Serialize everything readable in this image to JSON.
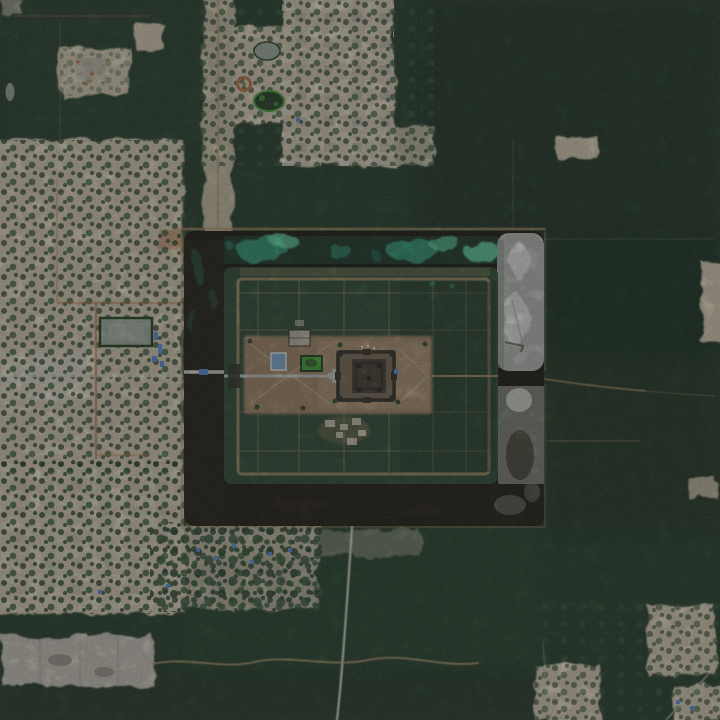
{
  "scene": {
    "type": "satellite-photograph",
    "subject": "Angkor Wat temple complex, aerial satellite view",
    "description": "Satellite image of the Angkor Wat temple complex: a dark rectangular moat with green algae blooms along its north arm and pale silted water on its east arm surrounds a forested enclosure containing the central stone temple on a cleared tan esplanade; village settlements and cleared land lie to the west and south-west, dense forest to the east and south, with dirt roads, ponds and a long grey cleared strip in the lower-left."
  },
  "features": {
    "moat": "Rectangular moat surrounding the temple enclosure",
    "north_moat_algae": "Bright green algae blooms in the north arm of the moat",
    "east_moat_silt": "Pale silted grey-white water in the east arm of the moat",
    "temple": "Central temple with concentric square galleries and quincunx towers",
    "esplanade": "Cleared tan esplanade around the central temple",
    "causeway": "West causeway and bridge crossing the moat",
    "enclosure": "Forested temple enclosure with a grid of paths inside a walled rectangle",
    "west_village": "Village and cleared land west of the moat",
    "top_village": "Patchwork village clearings north of the moat",
    "east_forest": "Dense forest east of the moat",
    "south_road": "Light dirt road running south from the moat",
    "cleared_strip": "Large grey cleared strip in the south-west",
    "ponds": "Village ponds, a blue pool and a green algae pond"
  },
  "colors": {
    "forest_base": "#203825",
    "forest_dark": "#172b1c",
    "forest_mid": "#26422c",
    "forest_light": "#2e4f35",
    "enclosure_forest": "#294630",
    "tree_dot": "#223d28",
    "tree_dot2": "#2f5237",
    "village_tan": "#cfc6ae",
    "village_light": "#ded7c6",
    "village_grey": "#b7b1a2",
    "cleared_grey": "#c2beb3",
    "road_orange": "#b4723e",
    "road_light": "#ccccc0",
    "path_tan": "#b2976c",
    "bank_tan": "#ad9166",
    "moat_dark": "#16140d",
    "moat_brown": "#241f14",
    "silt_grey": "#b2b6b1",
    "silt_white": "#e4e7e3",
    "silt_dark": "#858984",
    "silt_green": "#878b80",
    "algae_teal": "#2f9c75",
    "algae_bright": "#5dd0a2",
    "algae_deep": "#1d6b50",
    "esplanade": "#9c8164",
    "esplanade_light": "#ae9372",
    "temple_dark": "#2c2b23",
    "temple_mid": "#3e3a2e",
    "temple_tower": "#1f1e17",
    "temple_ground": "#746550",
    "terrace_grey": "#bcbfb7",
    "pond_green": "#3f9c34",
    "pond_dark": "#1d3a1e",
    "pool_blue": "#7ca7cd",
    "roof_blue": "#5289d6",
    "tarp_blue": "#4f8ad2",
    "pond_grey": "#9aa89c",
    "blotch_dark": "#6e6a5f"
  }
}
